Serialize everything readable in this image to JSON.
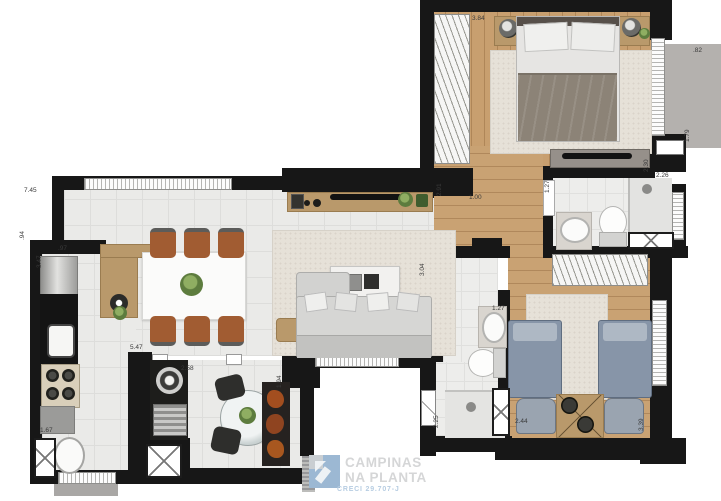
{
  "watermark": {
    "brand_line1": "CAMPINAS",
    "brand_line2": "NA PLANTA",
    "creci": "CRECI 29.707-J"
  },
  "colors": {
    "wall": "#171717",
    "wood_floor": "#c89f6f",
    "tile_floor": "#eaeae8",
    "terrace_gray": "#b4b1ae",
    "bed_blue": "#8795a8",
    "dining_chair_orange": "#a15c32",
    "watermark_text": "#d5d6d7",
    "watermark_blue": "#b7cde2",
    "logo_blue": "#9cb8d3"
  },
  "dimension_labels": [
    {
      "name": "bedroom1-width",
      "text": "3.84",
      "x": 472,
      "y": 16,
      "rot": 0
    },
    {
      "name": "bedroom1-wardrobe-length",
      "text": "2.91",
      "x": 437,
      "y": 196,
      "rot": 1
    },
    {
      "name": "terrace-depth",
      "text": ".82",
      "x": 693,
      "y": 48,
      "rot": 0
    },
    {
      "name": "terrace-length",
      "text": "1.79",
      "x": 685,
      "y": 142,
      "rot": 1
    },
    {
      "name": "bedroom1-dresser",
      "text": "2.30",
      "x": 644,
      "y": 172,
      "rot": 1
    },
    {
      "name": "bathroom1-length",
      "text": "2.26",
      "x": 656,
      "y": 173,
      "rot": 0
    },
    {
      "name": "bathroom1-width",
      "text": "1.27",
      "x": 545,
      "y": 193,
      "rot": 1
    },
    {
      "name": "hallway-width",
      "text": "1.00",
      "x": 469,
      "y": 195,
      "rot": 0
    },
    {
      "name": "living-depth",
      "text": "3.04",
      "x": 420,
      "y": 276,
      "rot": 1
    },
    {
      "name": "living-width",
      "text": "7.45",
      "x": 24,
      "y": 188,
      "rot": 0
    },
    {
      "name": "wall-segment-left",
      "text": ".94",
      "x": 20,
      "y": 240,
      "rot": 1
    },
    {
      "name": "kitchen-depth",
      "text": "3.47",
      "x": 37,
      "y": 268,
      "rot": 1
    },
    {
      "name": "kitchen-pass",
      "text": ".97",
      "x": 58,
      "y": 246,
      "rot": 0
    },
    {
      "name": "kitchen-length",
      "text": "5.47",
      "x": 130,
      "y": 345,
      "rot": 0
    },
    {
      "name": "office-width",
      "text": "2.58",
      "x": 181,
      "y": 366,
      "rot": 0
    },
    {
      "name": "office-depth",
      "text": "1.94",
      "x": 277,
      "y": 388,
      "rot": 1
    },
    {
      "name": "laundry-width",
      "text": "1.67",
      "x": 40,
      "y": 428,
      "rot": 0
    },
    {
      "name": "entry-corridor",
      "text": "2.25",
      "x": 434,
      "y": 428,
      "rot": 1
    },
    {
      "name": "bathroom2-width",
      "text": "1.27",
      "x": 492,
      "y": 306,
      "rot": 0
    },
    {
      "name": "bedroom2-width",
      "text": "2.44",
      "x": 515,
      "y": 419,
      "rot": 0
    },
    {
      "name": "bedroom2-depth",
      "text": "3.39",
      "x": 639,
      "y": 431,
      "rot": 1
    }
  ]
}
